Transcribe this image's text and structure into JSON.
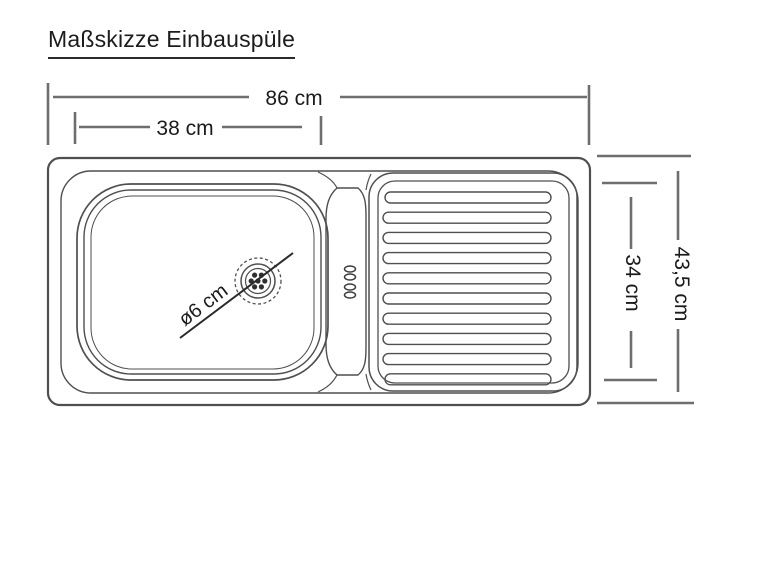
{
  "title": "Maßskizze Einbauspüle",
  "diagram": {
    "type": "technical-dimension-sketch",
    "subject": "built-in kitchen sink top view",
    "labels": {
      "overall_width": "86 cm",
      "basin_width": "38 cm",
      "overall_depth": "43,5 cm",
      "inner_depth": "34 cm",
      "drain_diameter": "ø6 cm"
    },
    "parts": [
      "sink outer rim",
      "basin bowl (left)",
      "tap deck (center)",
      "drainboard with 10 ribs (right)",
      "drain strainer with diagonal diameter line"
    ]
  },
  "colors": {
    "background": "#ffffff",
    "outline": "#4f4f4f",
    "dimension_line": "#6e6e6e",
    "text": "#1b1b1b"
  }
}
